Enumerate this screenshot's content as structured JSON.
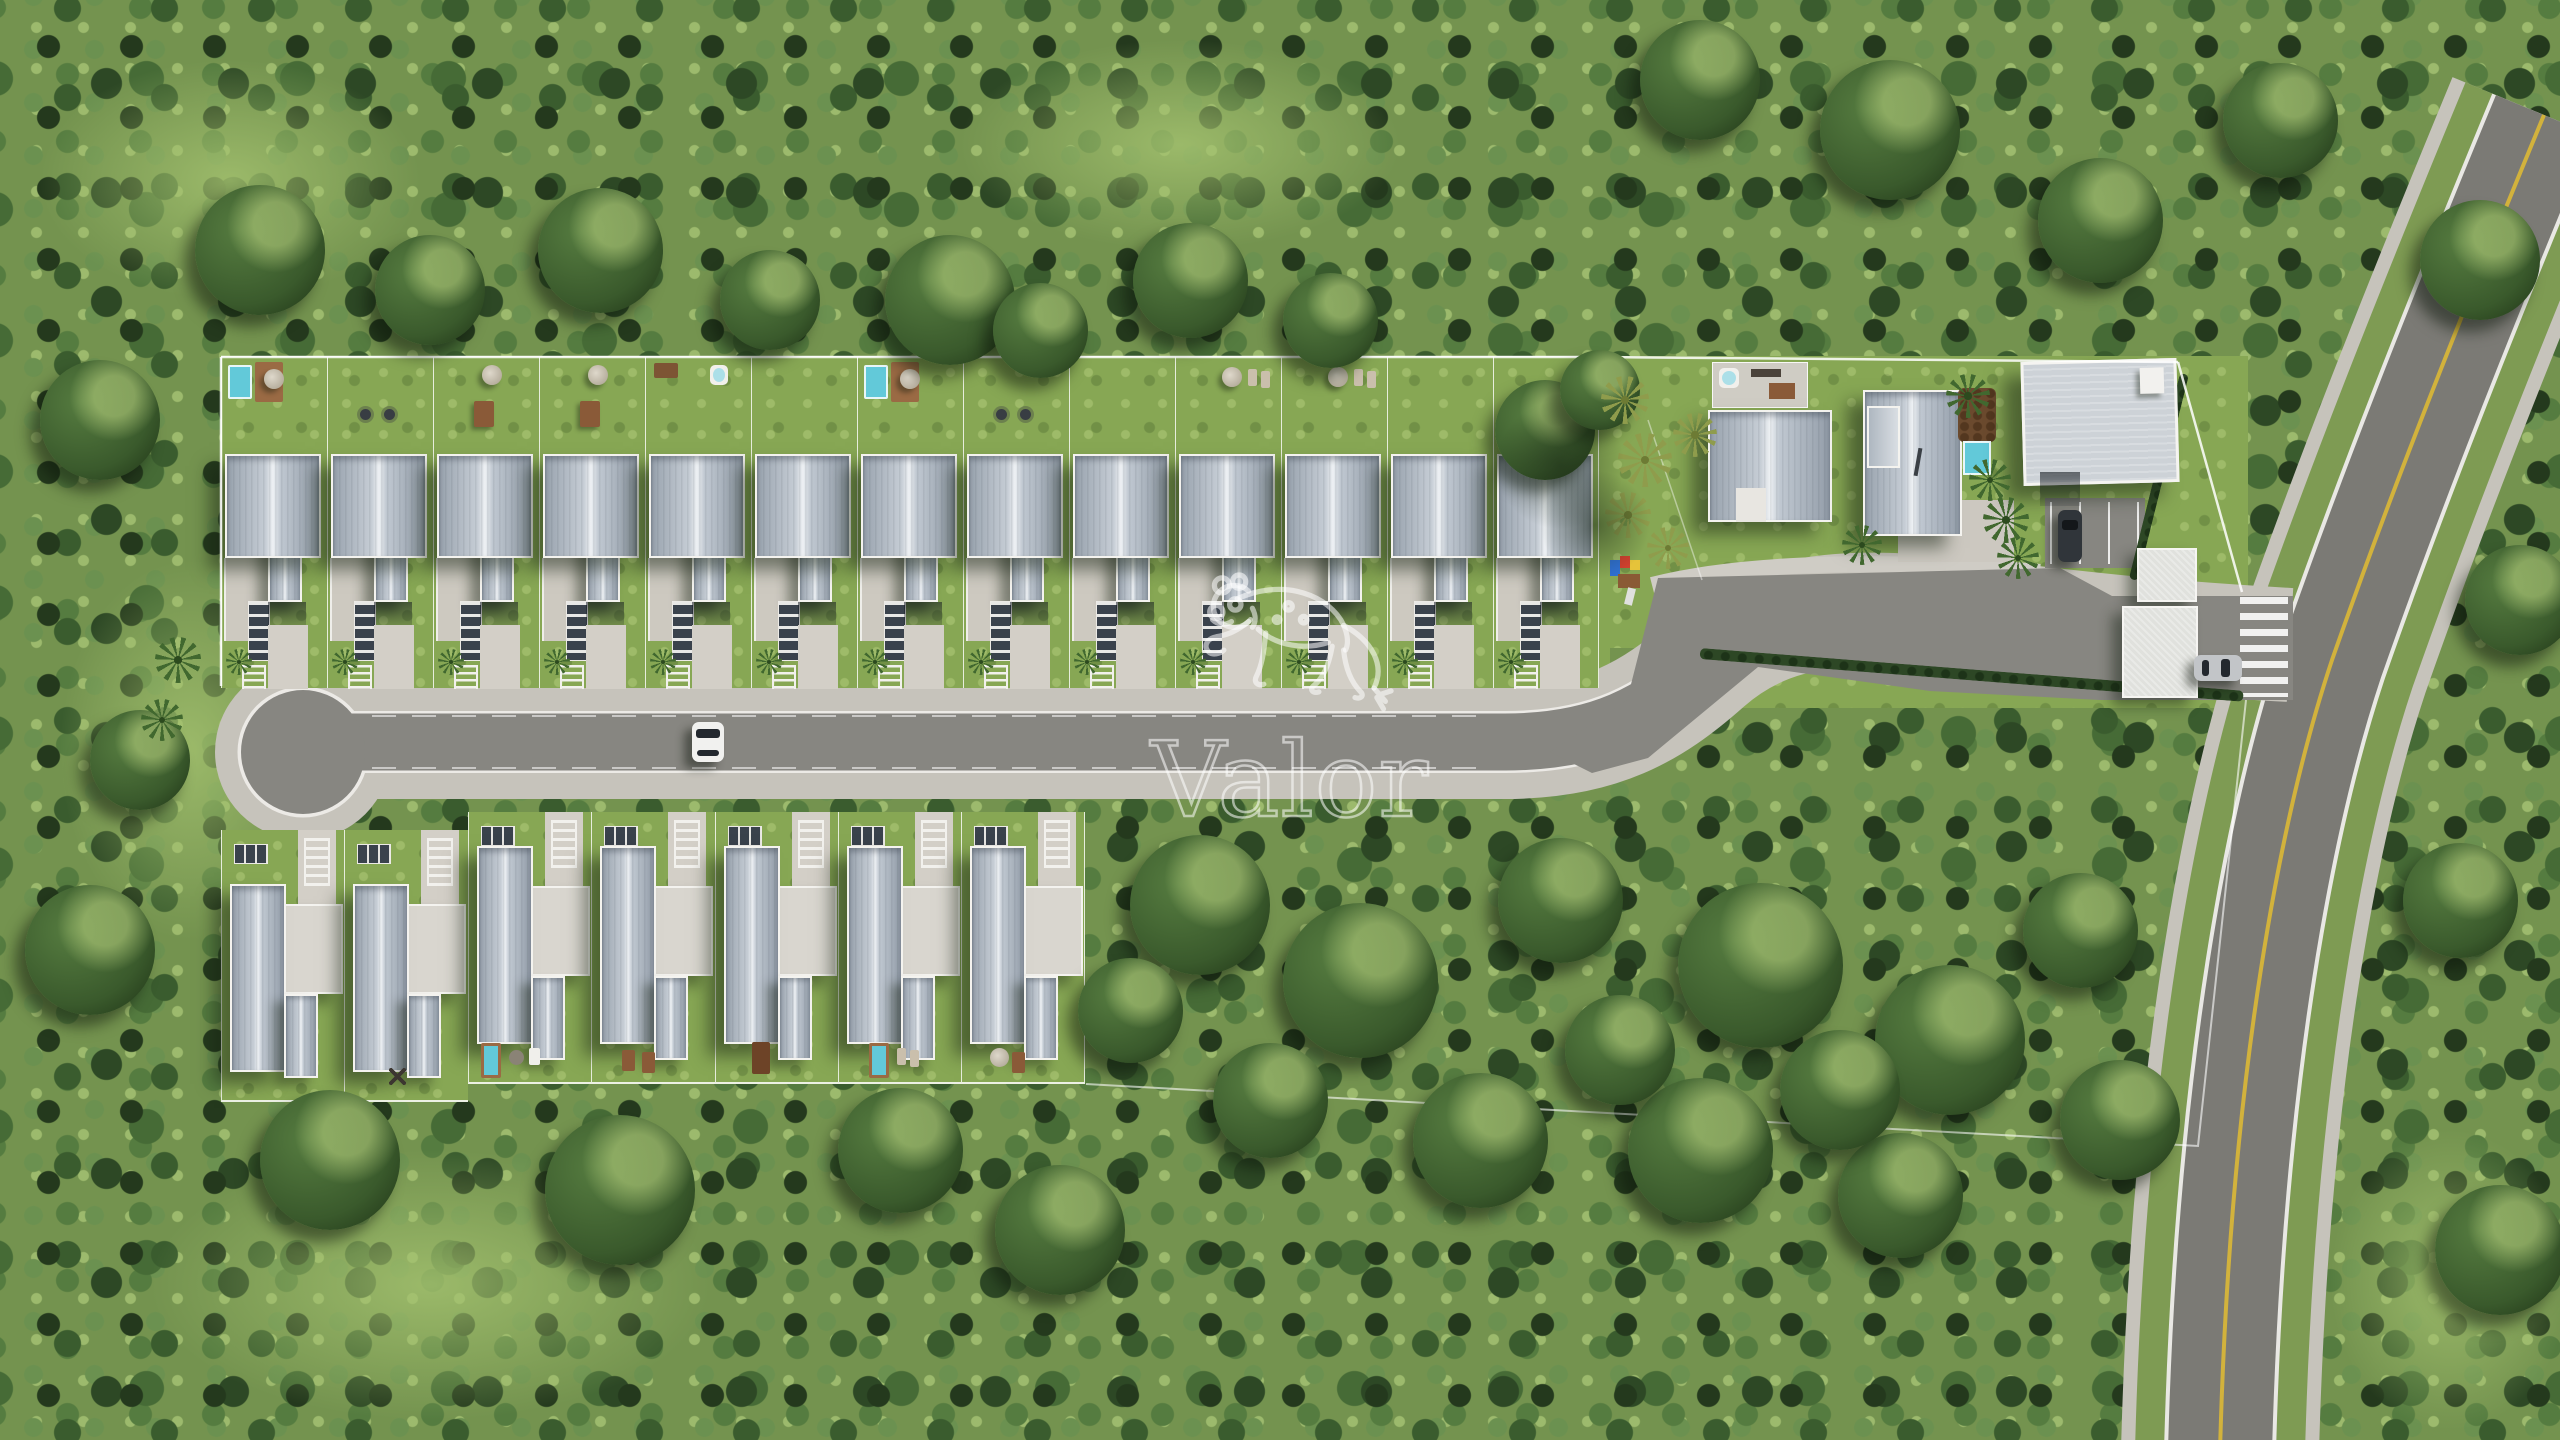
{
  "watermark": {
    "brand": "Valor",
    "icon": "jaguar-line-art-icon"
  },
  "site": {
    "top_row_houses": 13,
    "bottom_row_houses": 7,
    "amenity_buildings": [
      "reception-villa",
      "clubhouse-with-pool",
      "multipurpose-hall",
      "gate-canopy-north",
      "gate-canopy-south"
    ],
    "features": [
      "backyard-pools",
      "playground",
      "cul-de-sac",
      "entrance-crosswalk",
      "parking-bays",
      "perimeter-fence",
      "forest-reserve"
    ],
    "vehicles": [
      "white-car-on-street",
      "dark-car-in-parking",
      "silver-car-at-entrance"
    ]
  },
  "colors": {
    "forest_base": "#74934f",
    "grass": "#87a754",
    "asphalt": "#878681",
    "road_asphalt": "#7b7a75",
    "sidewalk": "#c6c3bb",
    "concrete": "#d3cfc7",
    "roof_ridge": "#eef1f4",
    "wall_white": "#f4f3ef",
    "dark_panel": "#3a424c",
    "pool": "#62c9d9",
    "wood": "#8a5a38",
    "hedge": "#2d4725",
    "lane_yellow": "#d2b23c",
    "watermark_white": "rgba(255,255,255,0.55)"
  }
}
